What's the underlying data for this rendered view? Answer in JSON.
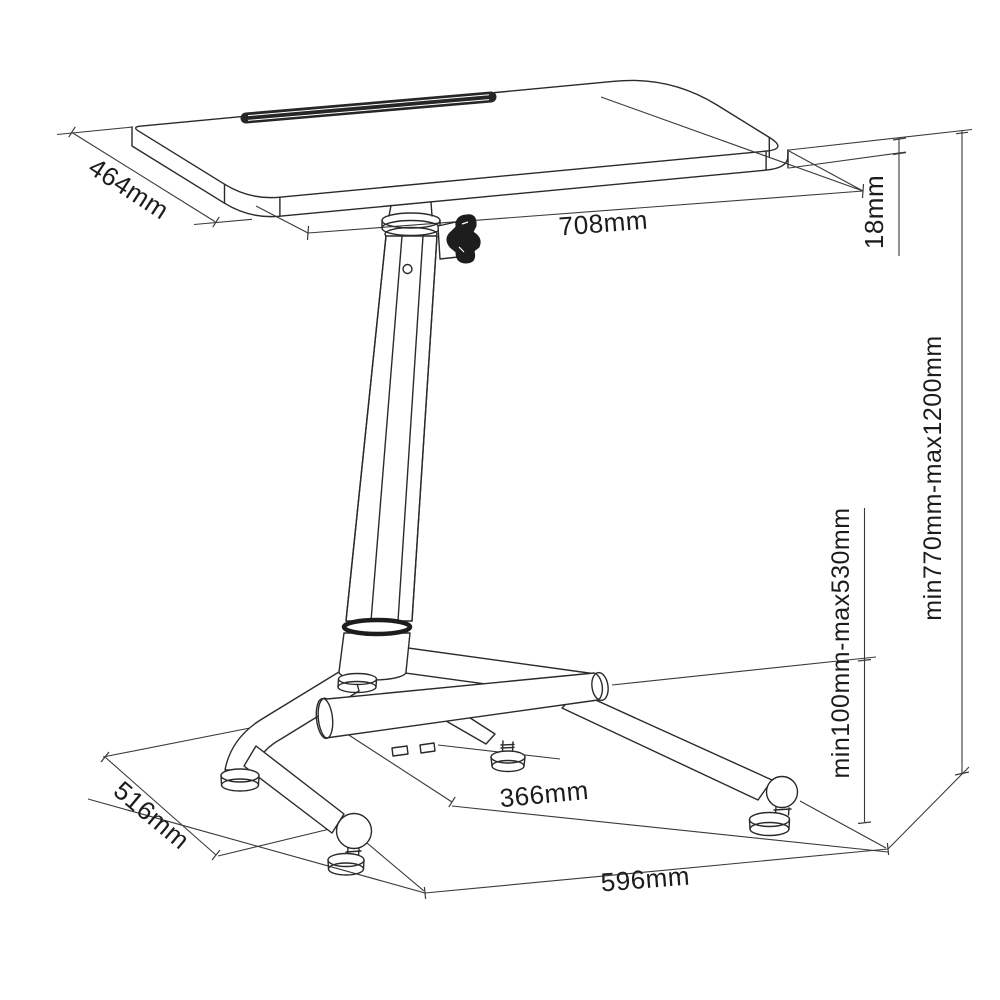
{
  "diagram": {
    "subject": "height-adjustable standing desk with footrest - dimension drawing",
    "background_color": "#ffffff",
    "line_color": "#2a2a2a",
    "dimensions": {
      "tabletop_depth": "464mm",
      "tabletop_width": "708mm",
      "tabletop_thickness": "18mm",
      "desk_height_range": "min770mm-max1200mm",
      "footrest_height_range": "min100mm-max530mm",
      "base_inner_depth": "366mm",
      "base_depth": "516mm",
      "base_width": "596mm"
    }
  }
}
